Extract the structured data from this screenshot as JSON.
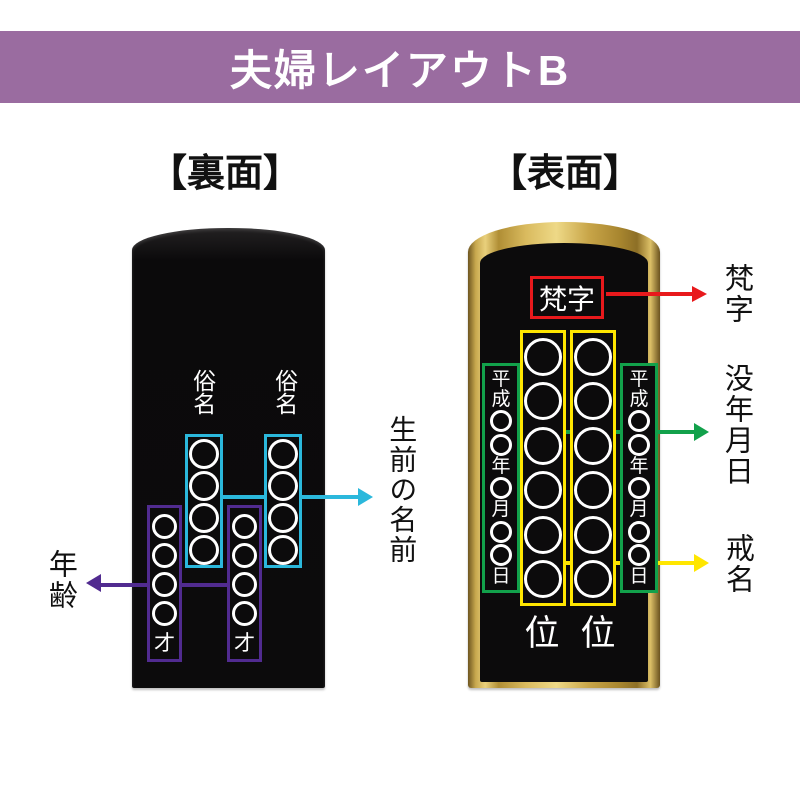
{
  "title_banner": {
    "text": "夫婦レイアウトB"
  },
  "colors": {
    "banner_bg": "#9a6ca0",
    "cyan": "#2bb8dc",
    "purple": "#512b90",
    "red": "#e8191c",
    "green": "#12a14b",
    "yellow": "#ffe600",
    "tablet_black": "#0c0b0c",
    "text_white": "#ffffff"
  },
  "back_panel": {
    "heading": "【裏面】",
    "name_column_header": "俗名",
    "name_circles_per_column": 4,
    "age_circles_per_column": 4,
    "age_suffix": "才",
    "annotation_name": "生前の名前",
    "annotation_age": "年齢"
  },
  "front_panel": {
    "heading": "【表面】",
    "bonji_box_text": "梵字",
    "date_column_items": [
      "平",
      "成",
      "○",
      "○",
      "年",
      "○",
      "月",
      "○",
      "○",
      "日"
    ],
    "kaimyo_circles_per_column": 6,
    "rank_char": "位",
    "annotation_bonji": "梵字",
    "annotation_date": "没年月日",
    "annotation_kaimyo": "戒名"
  }
}
